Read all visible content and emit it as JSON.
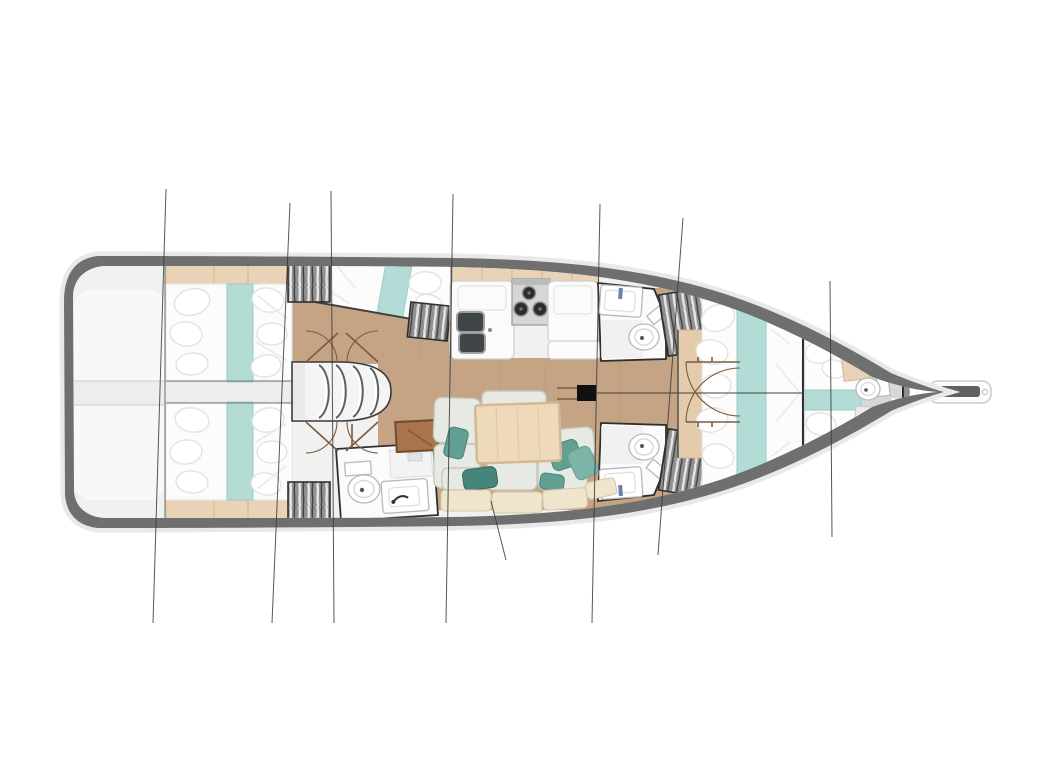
{
  "meta": {
    "title": "Sailing yacht interior layout plan",
    "description": "Top-down interior floor plan of a sailing yacht, bow pointing right, with cabins, galley, saloon, heads and rigging section lines",
    "type": "floorplan-rendering"
  },
  "colors": {
    "white": "#ffffff",
    "hull": "#6f6f6f",
    "hull_halo": "#e9e9e9",
    "deck": "#f1f1f1",
    "deck_white": "#f8f8f8",
    "corridor": "#ededed",
    "corridor_edge": "#cccccc",
    "gray_bow": "#8f8f8f",
    "box_floor": "#dfdfdf",
    "bath_floor": "#d7d7d7",
    "wood_floor": "#c5a485",
    "wood_grain": "#b2916f",
    "wood_shelf": "#e8d3b6",
    "wood_shelf_edge": "#d2b68f",
    "wood_headboard": "#e3cbab",
    "bed_white": "#fcfcfc",
    "bed_shadow": "#e3e3e3",
    "fold_line": "#ececec",
    "teal_runner": "#b2dcd5",
    "teal_runner_edge": "#9ccbc4",
    "teal_pillow": "#63a093",
    "teal_pillow_dark": "#45857a",
    "teal_pillow_light": "#7db4a8",
    "sofa_cushion": "#e7e9e3",
    "sofa_outline": "#c5c8bc",
    "bench_cushion": "#efe4cc",
    "bench_edge": "#d8c8a8",
    "table_wood": "#eed9ba",
    "table_edge": "#d4b993",
    "counter_white": "#fbfbfb",
    "counter_edge": "#cfcfcf",
    "sink_dark": "#3f4547",
    "sink_rim": "#9aa0a2",
    "stove_panel": "#d5d7d7",
    "stove_edge": "#9a9a9a",
    "burner_dark": "#2d2d2d",
    "fixture_outline": "#b9b9b9",
    "room_outline": "#2f2f2f",
    "wardrobe_bg": "#909090",
    "wardrobe_light": "#e6e6e6",
    "wardrobe_dark": "#424242",
    "door_arc": "#7d5b3f",
    "section_line": "#3a3a3a",
    "mast_black": "#101010",
    "chart_table": "#a8744b",
    "chart_table_edge": "#6f4c2f",
    "faucet_blue": "#6b82a8",
    "bulkhead": "#8a8a8a"
  },
  "vessel": {
    "orientation": "bow-right",
    "section_line_count": 8,
    "areas": [
      {
        "name": "swim-platform-transom"
      },
      {
        "name": "upper-aft-cabin",
        "fixtures": [
          "double-berth",
          "teal-runner",
          "pillows",
          "hanging-locker",
          "shelf"
        ]
      },
      {
        "name": "lower-aft-cabin",
        "fixtures": [
          "double-berth",
          "teal-runner",
          "pillows",
          "hanging-locker",
          "shelf"
        ]
      },
      {
        "name": "companionway-stairs",
        "fixtures": [
          "four-steps",
          "door-arcs"
        ]
      },
      {
        "name": "upper-mid-cabin",
        "fixtures": [
          "double-berth",
          "hanging-locker"
        ]
      },
      {
        "name": "galley",
        "fixtures": [
          "double-sink",
          "three-burner-stove",
          "counters",
          "lockers"
        ]
      },
      {
        "name": "lower-day-head",
        "fixtures": [
          "toilet",
          "washbasin"
        ]
      },
      {
        "name": "saloon",
        "fixtures": [
          "u-shaped-sofa",
          "dining-table",
          "chart-table",
          "nav-seat",
          "throw-pillows",
          "hull-bench"
        ]
      },
      {
        "name": "upper-forward-head",
        "fixtures": [
          "toilet",
          "washbasin",
          "hanging-locker"
        ]
      },
      {
        "name": "lower-forward-head",
        "fixtures": [
          "toilet",
          "washbasin",
          "hanging-locker"
        ]
      },
      {
        "name": "forward-owner-cabin",
        "fixtures": [
          "double-berth",
          "teal-runner",
          "pillows",
          "headboard-shelf"
        ]
      },
      {
        "name": "forepeak-crew-cabin",
        "fixtures": [
          "berth",
          "toilet",
          "shower",
          "locker"
        ]
      },
      {
        "name": "mast"
      },
      {
        "name": "bowsprit"
      }
    ]
  }
}
